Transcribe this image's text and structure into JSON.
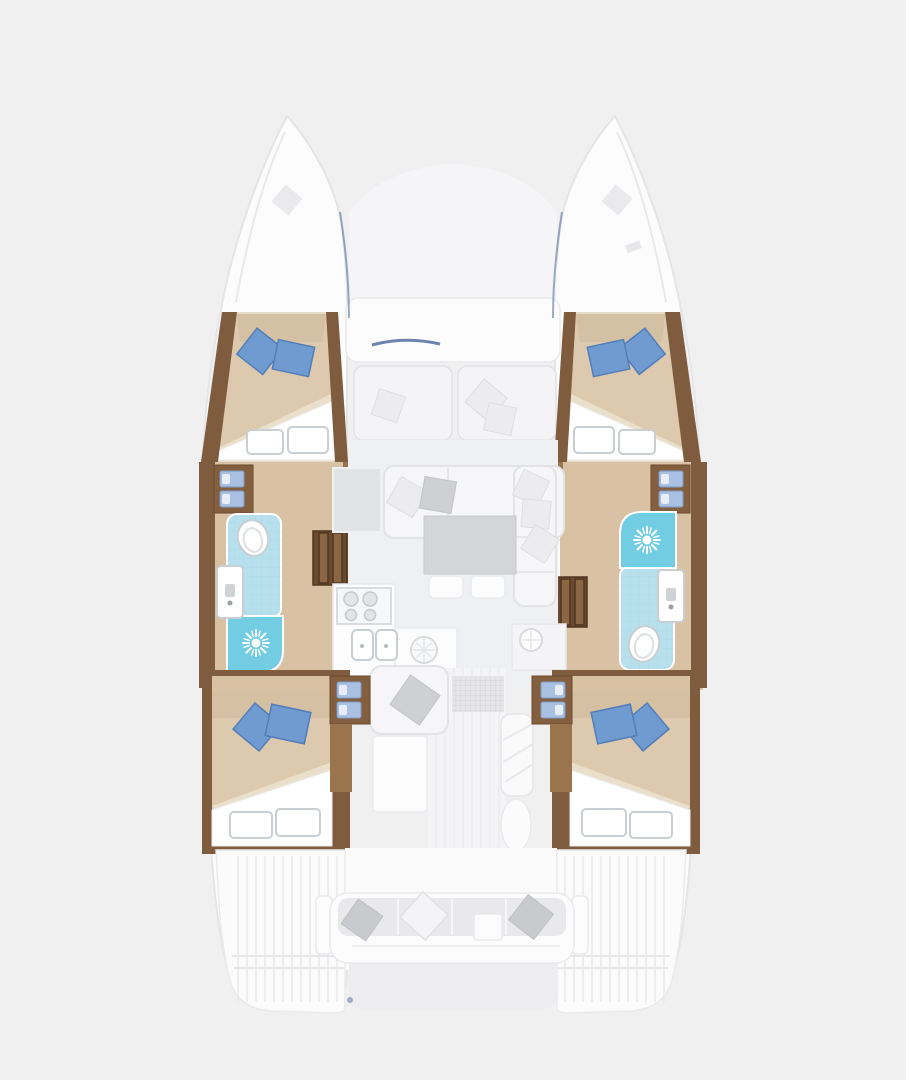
{
  "page": {
    "background": "#f0f0f1",
    "description": "Top-down catamaran interior deck plan, 4 cabins, 2 bathrooms, saloon with galley"
  },
  "colors": {
    "bg": "#f0f0f1",
    "hull": "#fcfcfd",
    "hullLine": "#e4e5e7",
    "deckStripe": "#e9e9eb",
    "wood": "#7e5c3d",
    "woodDark": "#6a4a2e",
    "woodMid": "#845f3f",
    "woodLight": "#9a744d",
    "floor": "#d9c2a4",
    "stairs": "#6a4a2e",
    "stairSlat": "#8a6645",
    "bed": "#dcc9ae",
    "bedShade": "#d0bb9b",
    "blanket": "#ffffff",
    "pillowBlue": "#6f9bd0",
    "pillowBlueDark": "#537eb9",
    "stepBlue": "#a9c0e2",
    "bathLight": "#b8e0ec",
    "bathTile": "#9fd2e2",
    "shower": "#72cce2",
    "fixtureStroke": "#c9ced3",
    "saloonFloor": "#eff0f2",
    "sofa": "#f6f6f8",
    "sofaLine": "#e2e3e5",
    "cushionGrey": "#cfd0d3",
    "cushionLight": "#ececee",
    "table": "#d4d5d7",
    "counter": "#dcdde0",
    "navy": "#3c5c92",
    "recess": "#ededef"
  },
  "rooms": {
    "bow_port": {
      "label": "Port bow foredeck with deck hatch"
    },
    "bow_starboard": {
      "label": "Starboard bow foredeck with deck hatch"
    },
    "trampoline": {
      "label": "Foredeck area between bows"
    },
    "forward_cockpit": {
      "label": "Forward cockpit bench with white scatter cushions"
    },
    "cabin_forward_port": {
      "label": "Forward port cabin, double berth with 2 blue pillows and white blanket"
    },
    "cabin_forward_starboard": {
      "label": "Forward starboard cabin, double berth with 2 blue pillows and white blanket"
    },
    "bathroom_port": {
      "label": "Port bathroom, toilet, washbasin and shower with shower rose"
    },
    "bathroom_starboard": {
      "label": "Starboard bathroom, shower with shower rose, washbasin and toilet"
    },
    "stairs_port": {
      "label": "Port hull companionway stairs"
    },
    "stairs_starboard": {
      "label": "Starboard hull companionway stairs"
    },
    "galley": {
      "label": "Galley with 4-burner hob, double sink and round hatch"
    },
    "saloon": {
      "label": "Saloon with L-shaped sofa, cushions, table and 2 stools"
    },
    "sideboard_starboard": {
      "label": "Starboard sideboard counter with round hatch"
    },
    "lounge_chaise": {
      "label": "Chaise seat with grey cushion"
    },
    "sun_pad": {
      "label": "Sun pad aft of saloon"
    },
    "doormat": {
      "label": "Cockpit door mat"
    },
    "cabin_aft_port": {
      "label": "Aft port cabin, double berth with 2 blue pillows, storage steps"
    },
    "cabin_aft_starboard": {
      "label": "Aft starboard cabin, double berth with 2 blue pillows, storage steps"
    },
    "aft_cockpit": {
      "label": "Aft cockpit bench with 3 cushions and small table"
    },
    "swim_platform_port": {
      "label": "Port transom swim platform"
    },
    "swim_platform_starboard": {
      "label": "Starboard transom swim platform"
    }
  },
  "icons": [
    "shower-rose-icon",
    "toilet-icon",
    "washbasin-icon",
    "stove-burner-icon",
    "sink-icon",
    "hatch-icon",
    "step-tread-icon",
    "deck-hatch-icon"
  ]
}
